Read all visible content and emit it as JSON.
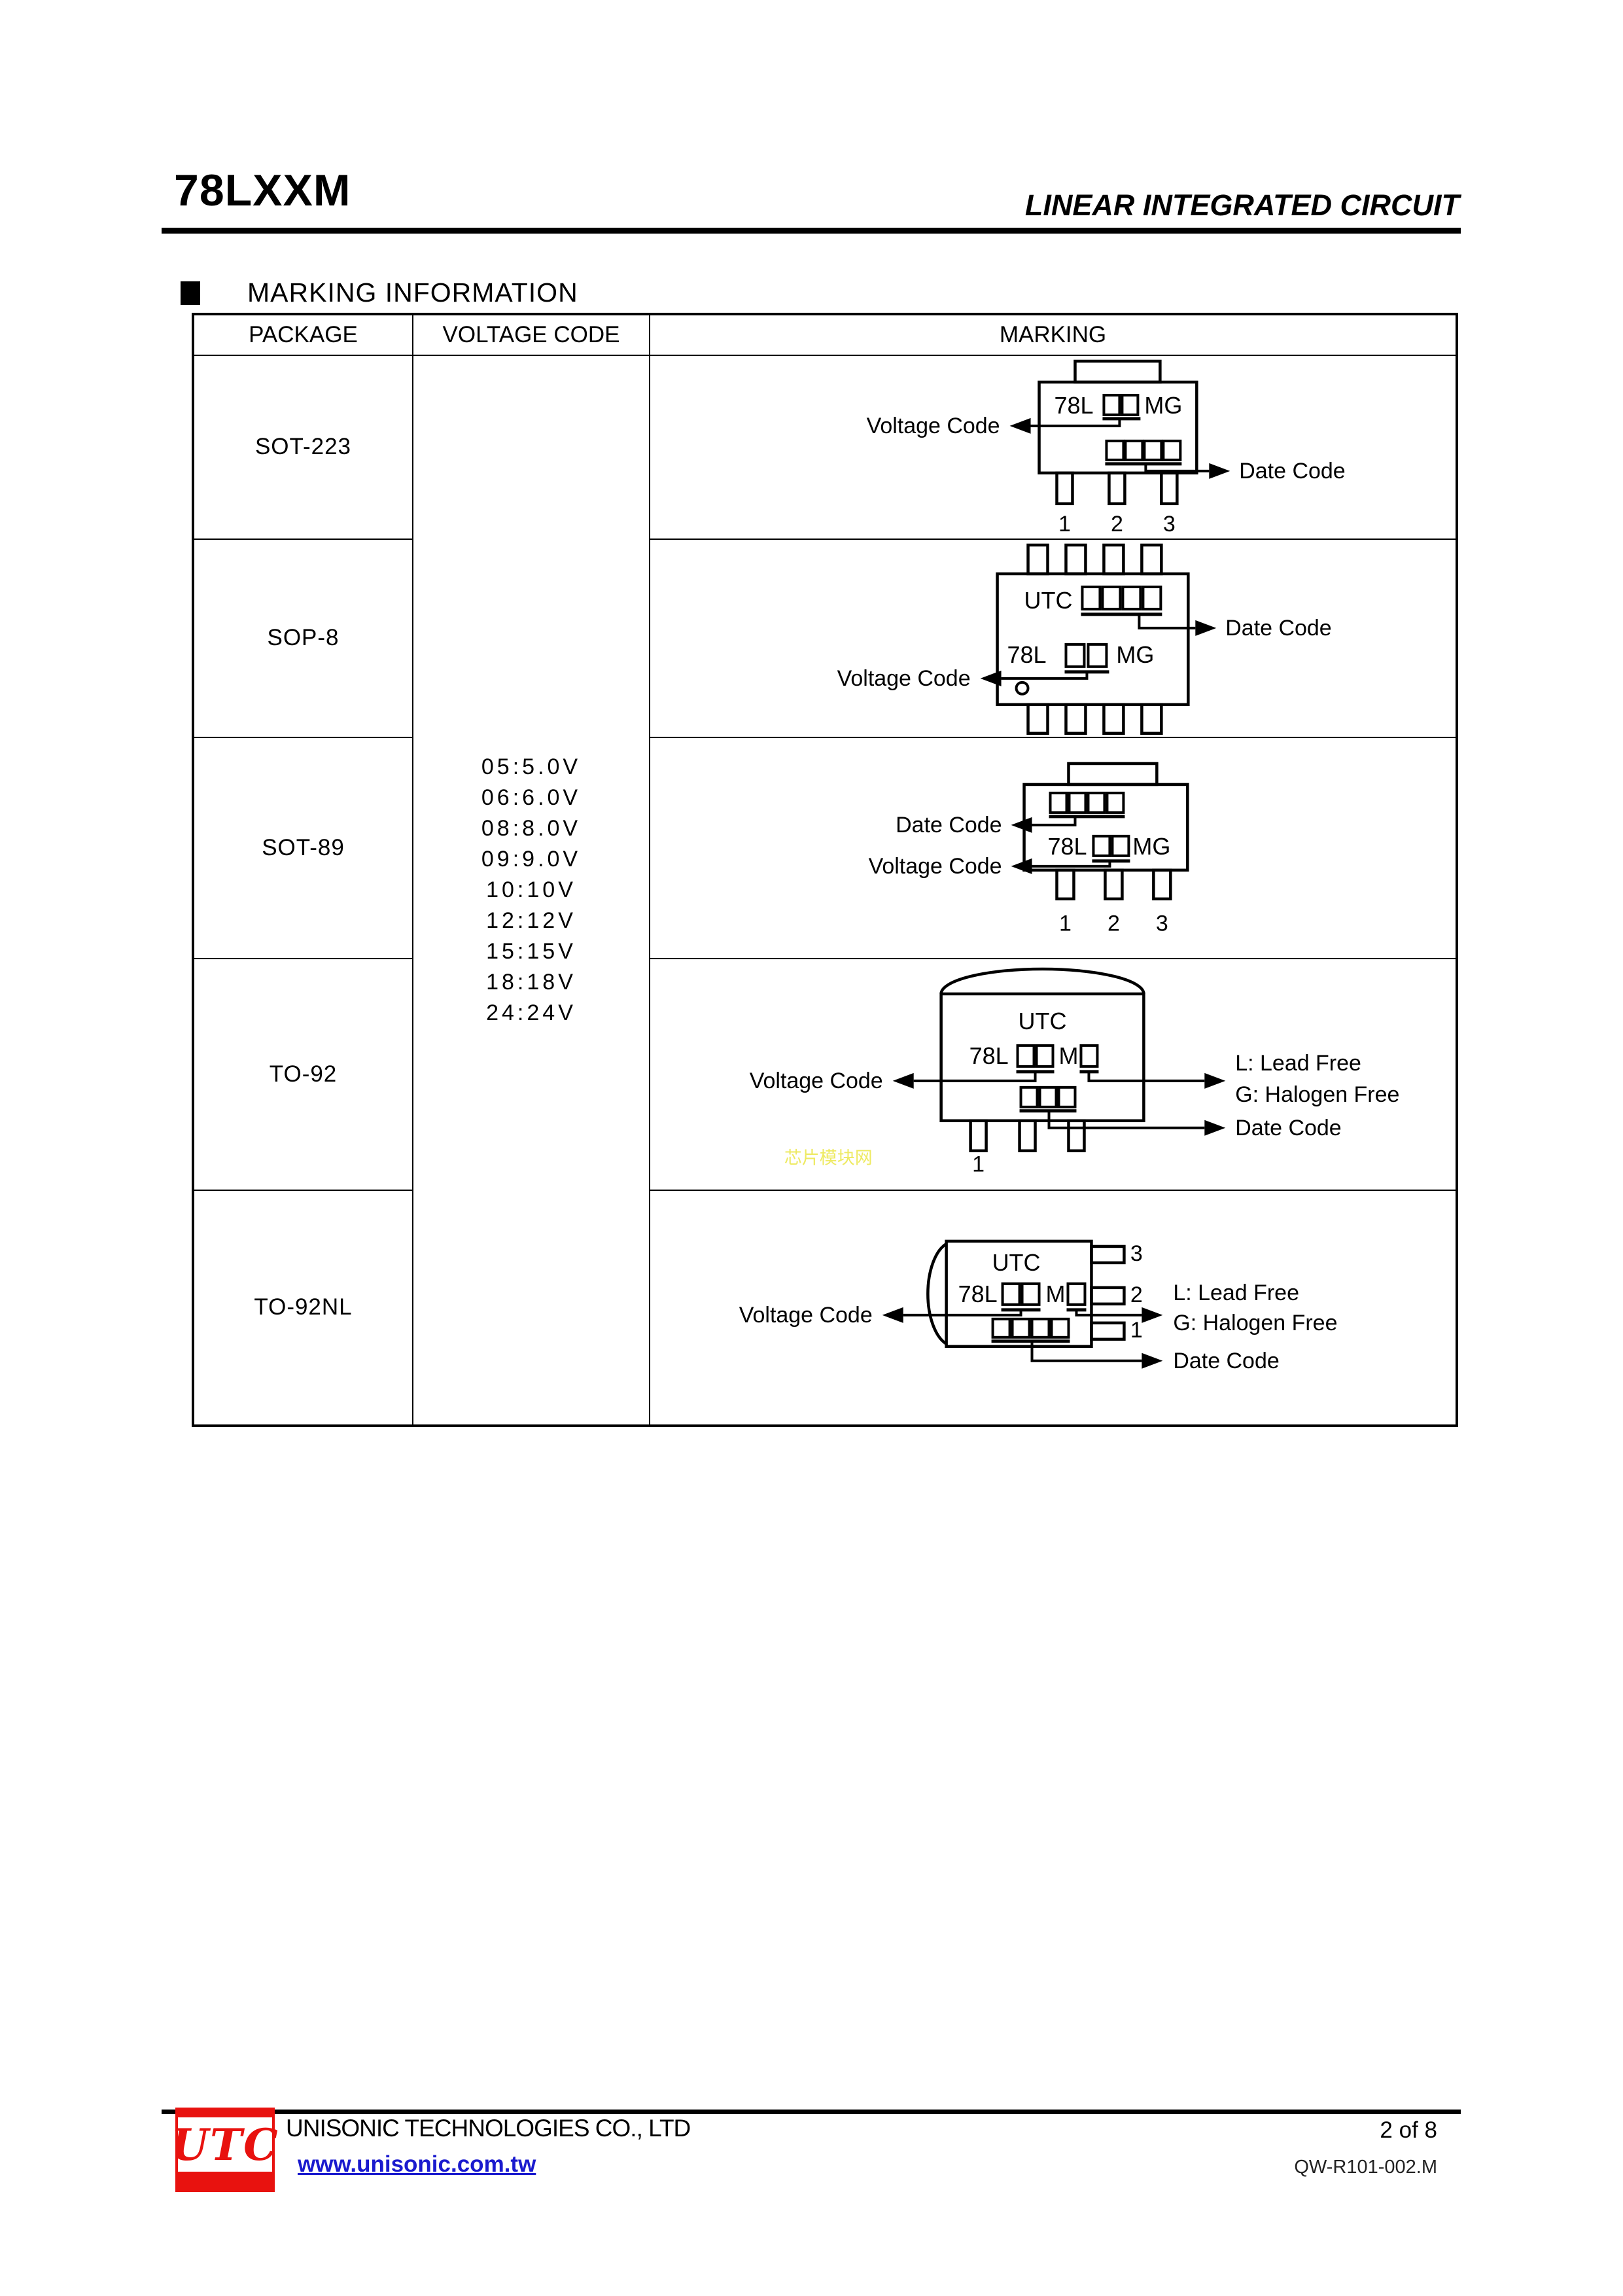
{
  "header": {
    "part_number": "78LXXM",
    "doc_type": "LINEAR INTEGRATED CIRCUIT"
  },
  "section_title": "MARKING INFORMATION",
  "table": {
    "headers": {
      "package": "PACKAGE",
      "voltage": "VOLTAGE CODE",
      "marking": "MARKING"
    },
    "packages": [
      "SOT-223",
      "SOP-8",
      "SOT-89",
      "TO-92",
      "TO-92NL"
    ],
    "voltage_codes": [
      "05:5.0V",
      "06:6.0V",
      "08:8.0V",
      "09:9.0V",
      "10:10V",
      "12:12V",
      "15:15V",
      "18:18V",
      "24:24V"
    ]
  },
  "marking": {
    "brand": "UTC",
    "prefix": "78L",
    "suffix_mg": "MG",
    "m": "M",
    "labels": {
      "voltage": "Voltage Code",
      "date": "Date Code",
      "lead_free": "L: Lead Free",
      "halogen_free": "G: Halogen Free"
    },
    "pins": {
      "sot223": [
        "1",
        "2",
        "3"
      ],
      "sot89": [
        "1",
        "2",
        "3"
      ],
      "to92": [
        "1"
      ],
      "to92nl": [
        "3",
        "2",
        "1"
      ]
    }
  },
  "watermark": {
    "text": "芯片模块网",
    "color": "#eeea62"
  },
  "footer": {
    "logo_text": "UTC",
    "company": "UNISONIC TECHNOLOGIES CO., LTD",
    "website": "www.unisonic.com.tw",
    "page_label": "2 of 8",
    "doc_code": "QW-R101-002.M"
  }
}
